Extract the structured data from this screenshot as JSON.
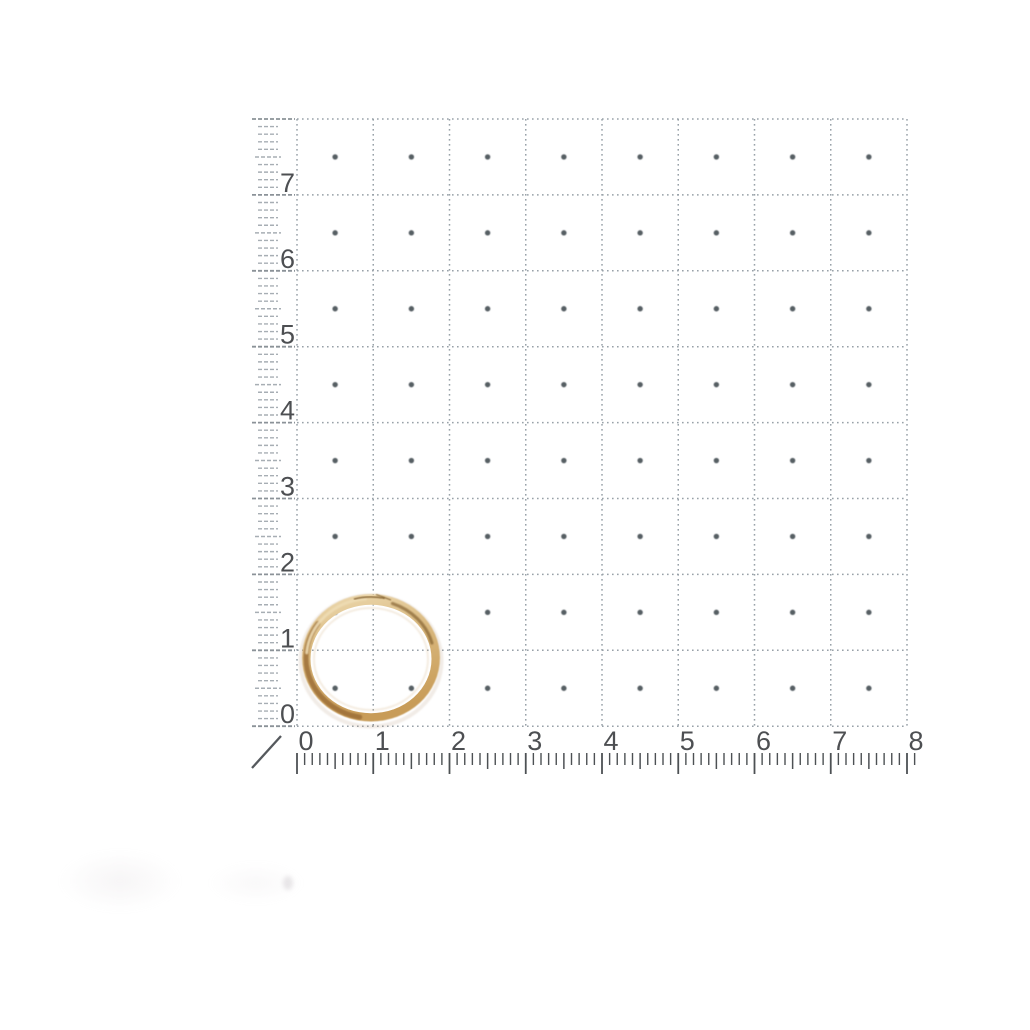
{
  "photo": {
    "background_color": "#ffffff",
    "paper_color": "#fefefe"
  },
  "grid": {
    "rows": 8,
    "columns": 8,
    "minor_ticks_per_unit": 10,
    "line_color": "#98a1a8",
    "center_dot_color": "#565e64"
  },
  "left_ruler": {
    "labels": [
      "7",
      "6",
      "5",
      "4",
      "3",
      "2",
      "1",
      "0"
    ],
    "number_color": "#3a3d40",
    "tick_color": "#a7aeb4",
    "major_tick_color": "#8b9298"
  },
  "bottom_ruler": {
    "labels": [
      "0",
      "1",
      "2",
      "3",
      "4",
      "5",
      "6",
      "7",
      "8"
    ],
    "number_color": "#3a3d40",
    "tick_color": "#4d5154"
  },
  "zero_mark": {
    "color": "#55595d"
  },
  "ring": {
    "name": "gold-hoop-ring",
    "band_base": "#d9b87e",
    "band_light": "#eedcb4",
    "band_mid": "#c89c58",
    "band_shadow": "#9a6c34",
    "band_dark": "#7e5c2c"
  }
}
